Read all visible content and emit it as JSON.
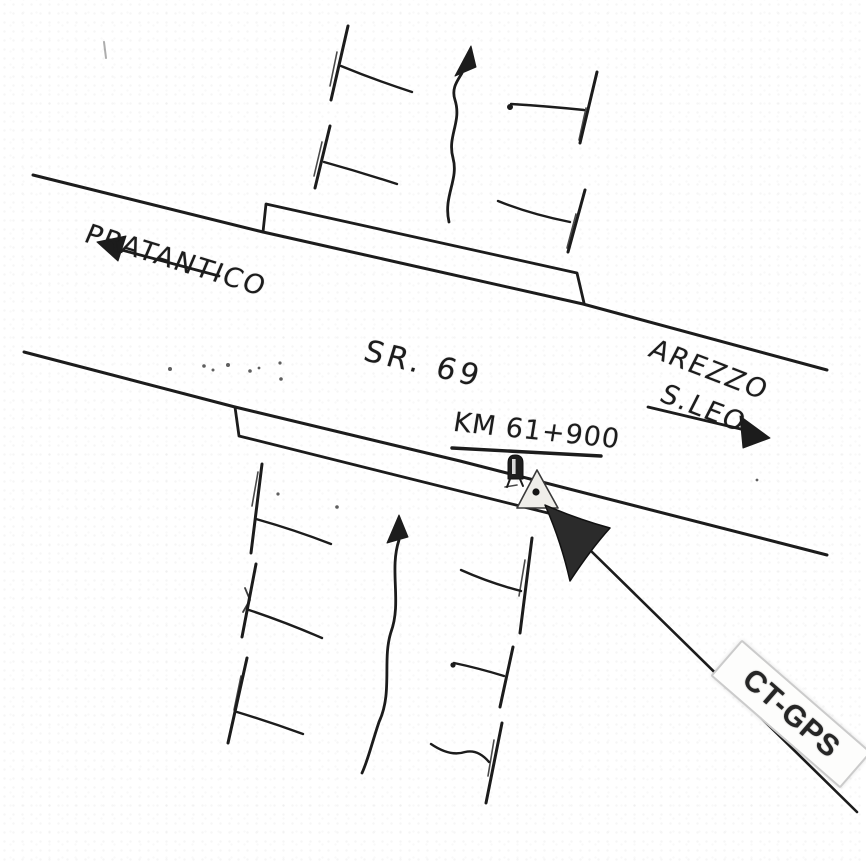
{
  "sketch": {
    "road_label": "SR. 69",
    "km_label": "KM 61+900",
    "left_destination": "PRATANTICO",
    "right_destination_line1": "AREZZO",
    "right_destination_line2": "S.LEO",
    "watermark_label": "CT-GPS",
    "colors": {
      "ink": "#1c1c1c",
      "paper": "#ffffff",
      "label_border": "#cbcbcb",
      "gps_marker_fill": "#efeeea",
      "pointer_fill": "#2b2b2b"
    }
  }
}
